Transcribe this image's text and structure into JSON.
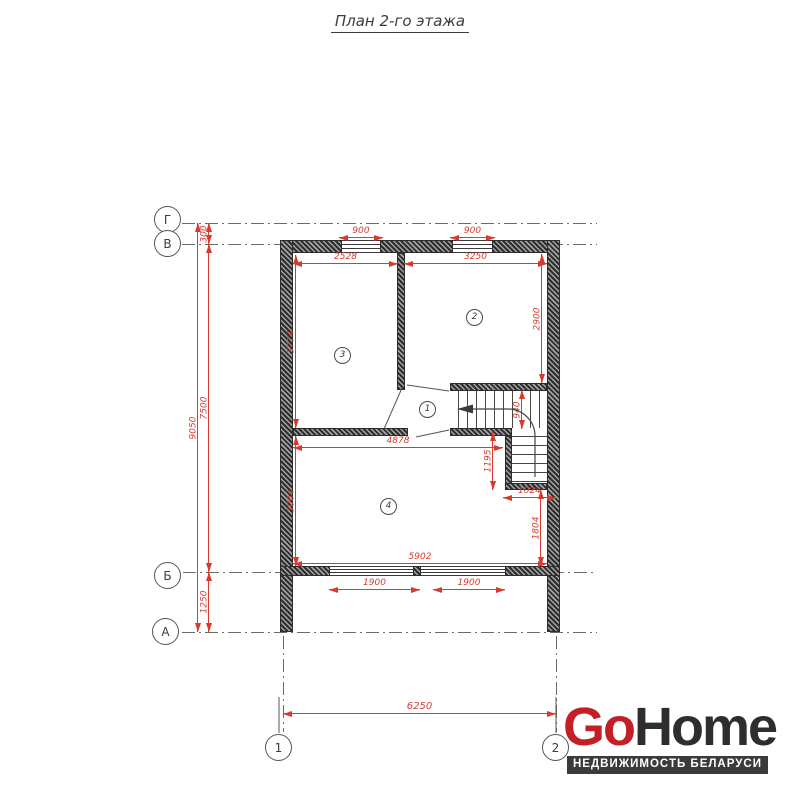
{
  "title": "План 2-го этажа",
  "axis_labels": {
    "g": "Г",
    "v": "В",
    "b": "Б",
    "a": "А",
    "c1": "1",
    "c2": "2"
  },
  "room_numbers": {
    "r1": "1",
    "r2": "2",
    "r3": "3",
    "r4": "4"
  },
  "dimensions": {
    "d300": "300",
    "d9050": "9050",
    "d7500": "7500",
    "d1250": "1250",
    "d900a": "900",
    "d900b": "900",
    "d2528": "2528",
    "d3250": "3250",
    "d3774": "3774",
    "d2900": "2900",
    "d940": "940",
    "d4878": "4878",
    "d1195": "1195",
    "d1024": "1024",
    "d1804": "1804",
    "d3004": "3004",
    "d5902": "5902",
    "d1900a": "1900",
    "d1900b": "1900",
    "d6250": "6250"
  },
  "logo": {
    "go": "Go",
    "home": "Home",
    "tagline": "НЕДВИЖИМОСТЬ БЕЛАРУСИ"
  },
  "colors": {
    "dimension_red": "#d93a2d",
    "wall_dark": "#3a3a3a",
    "logo_red": "#c41e26",
    "logo_dark": "#2f2e2e"
  }
}
